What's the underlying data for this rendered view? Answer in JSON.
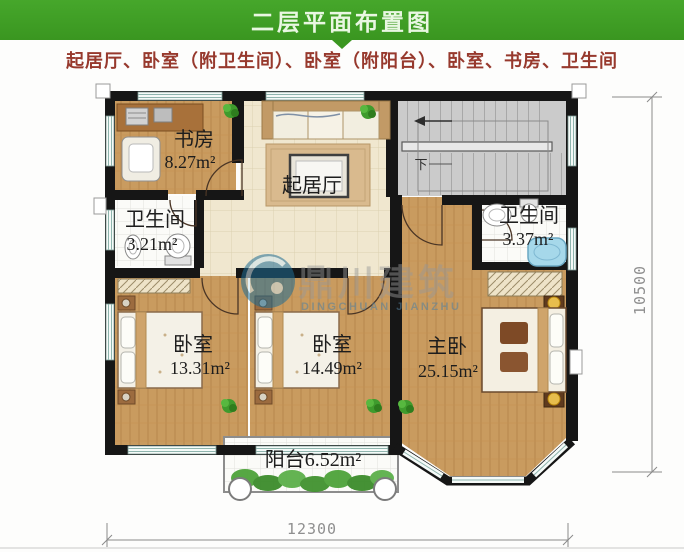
{
  "header": {
    "title": "二层平面布置图"
  },
  "subtitle": "起居厅、卧室（附卫生间）、卧室（附阳台）、卧室、书房、卫生间",
  "rooms": {
    "study": {
      "name": "书房",
      "area": "8.27m²"
    },
    "bath_left": {
      "name": "卫生间",
      "area": "3.21m²"
    },
    "living": {
      "name": "起居厅"
    },
    "bath_right": {
      "name": "卫生间",
      "area": "3.37m²"
    },
    "bedroom_left": {
      "name": "卧室",
      "area": "13.31m²"
    },
    "bedroom_mid": {
      "name": "卧室",
      "area": "14.49m²"
    },
    "master": {
      "name": "主卧",
      "area": "25.15m²"
    },
    "balcony": {
      "label": "阳台6.52m²"
    }
  },
  "stairs": {
    "down_label": "下"
  },
  "dimensions": {
    "bottom_width": "12300",
    "right_height": "10500"
  },
  "watermark": {
    "cn": "鼎川建筑",
    "en": "DINGCHUAN JIANZHU"
  },
  "colors": {
    "header_green": "#3f9e22",
    "subtitle_red": "#97392d",
    "wall_black": "#161616",
    "wood_floor": "#c99b5f",
    "tile_beige": "#f0e7cf",
    "stair_gray": "#cbcbcb",
    "watermark_blue": "#1f6d94",
    "bathtub_blue": "#a6d8ea"
  }
}
